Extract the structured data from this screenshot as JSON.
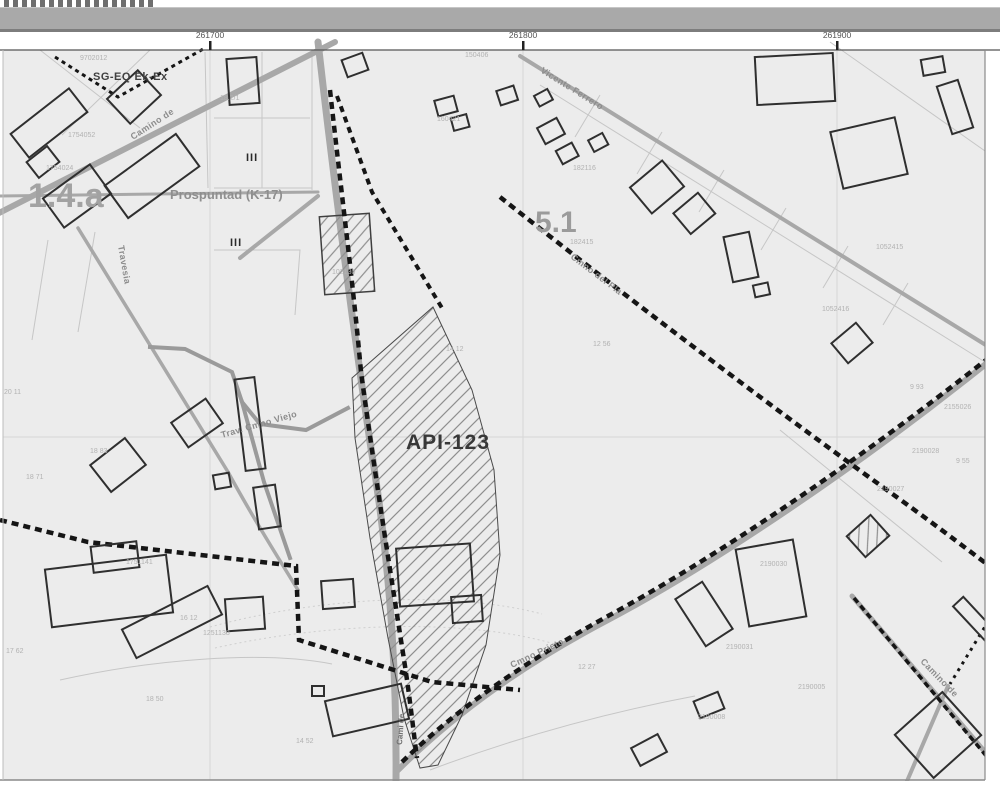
{
  "map": {
    "coordinates": [
      "261700",
      "261800",
      "261900"
    ],
    "zones": {
      "sg_eq": "SG-EQ Ek-Ex",
      "area_14a": "1.4.a",
      "prospuntad": "Prospuntad (K-17)",
      "area_51": "5.1",
      "api": "API-123"
    },
    "streets": {
      "camino_de_nw": "Camino de",
      "travesia": "Travesia",
      "vicente_ferrero": "Vicente Ferrero",
      "cmno_del_pla": "Cmno del Pla",
      "trav_cmno_viejo": "Trav. Cmno Viejo",
      "cmno_prieto": "Cmno Prieto",
      "camino_de_se": "Camino de",
      "cami_s": "Cami de"
    },
    "roman_numerals": [
      "III",
      "III"
    ],
    "parcel_numbers": [
      "9702012",
      "1754052",
      "1754024",
      "18.2/1",
      "102130",
      "150406",
      "160421",
      "182116",
      "182415",
      "1052416",
      "1052415",
      "2155026",
      "2190028",
      "2190027",
      "2190030",
      "2190031",
      "2190005",
      "2190008",
      "1251138",
      "1751141",
      "12 27",
      "16 12",
      "14 52",
      "18 50",
      "17 62",
      "20 11",
      "18 71",
      "18 83",
      "9 93",
      "9 55",
      "12 56",
      "14 12"
    ],
    "colors": {
      "map_bg": "#ececec",
      "boundary": "#151515",
      "road": "#a8a8a8",
      "zone_label_gray": "#a2a2a2",
      "building_outline": "#2f2f2f"
    }
  }
}
